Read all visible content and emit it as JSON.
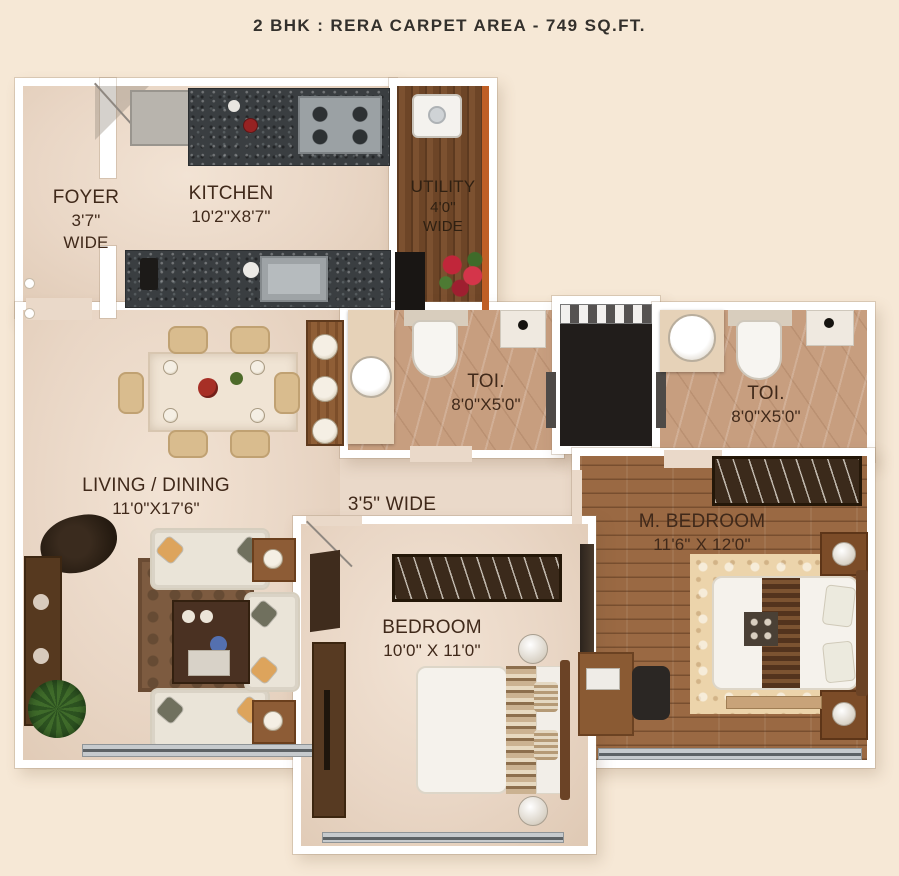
{
  "title": "2 BHK : RERA CARPET AREA - 749 SQ.FT.",
  "rooms": {
    "foyer": {
      "name": "FOYER",
      "size": "3'7\"",
      "note": "WIDE"
    },
    "kitchen": {
      "name": "KITCHEN",
      "size": "10'2\"X8'7\""
    },
    "utility": {
      "name": "UTILITY",
      "size": "4'0\"",
      "note": "WIDE"
    },
    "toilet_common": {
      "name": "TOI.",
      "size": "8'0\"X5'0\""
    },
    "toilet_master": {
      "name": "TOI.",
      "size": "8'0\"X5'0\""
    },
    "living_dining": {
      "name": "LIVING / DINING",
      "size": "11'0\"X17'6\""
    },
    "passage": {
      "name": "3'5\" WIDE"
    },
    "master_bedroom": {
      "name": "M. BEDROOM",
      "size": "11'6\" X 12'0\""
    },
    "bedroom": {
      "name": "BEDROOM",
      "size": "10'0\" X 11'0\""
    }
  },
  "colors": {
    "background": "#f6e8d6",
    "wall": "#ffffff",
    "floor_beige": "#ead9c9",
    "granite_counter": "#3a3e41",
    "marble_toilet": "#c79e7f",
    "utility_wood": "#72482a",
    "bedroom_wood": "#9a6943",
    "lift_shaft": "#211d1b",
    "utility_accent": "#bf5f26",
    "label_text": "#40291a"
  }
}
